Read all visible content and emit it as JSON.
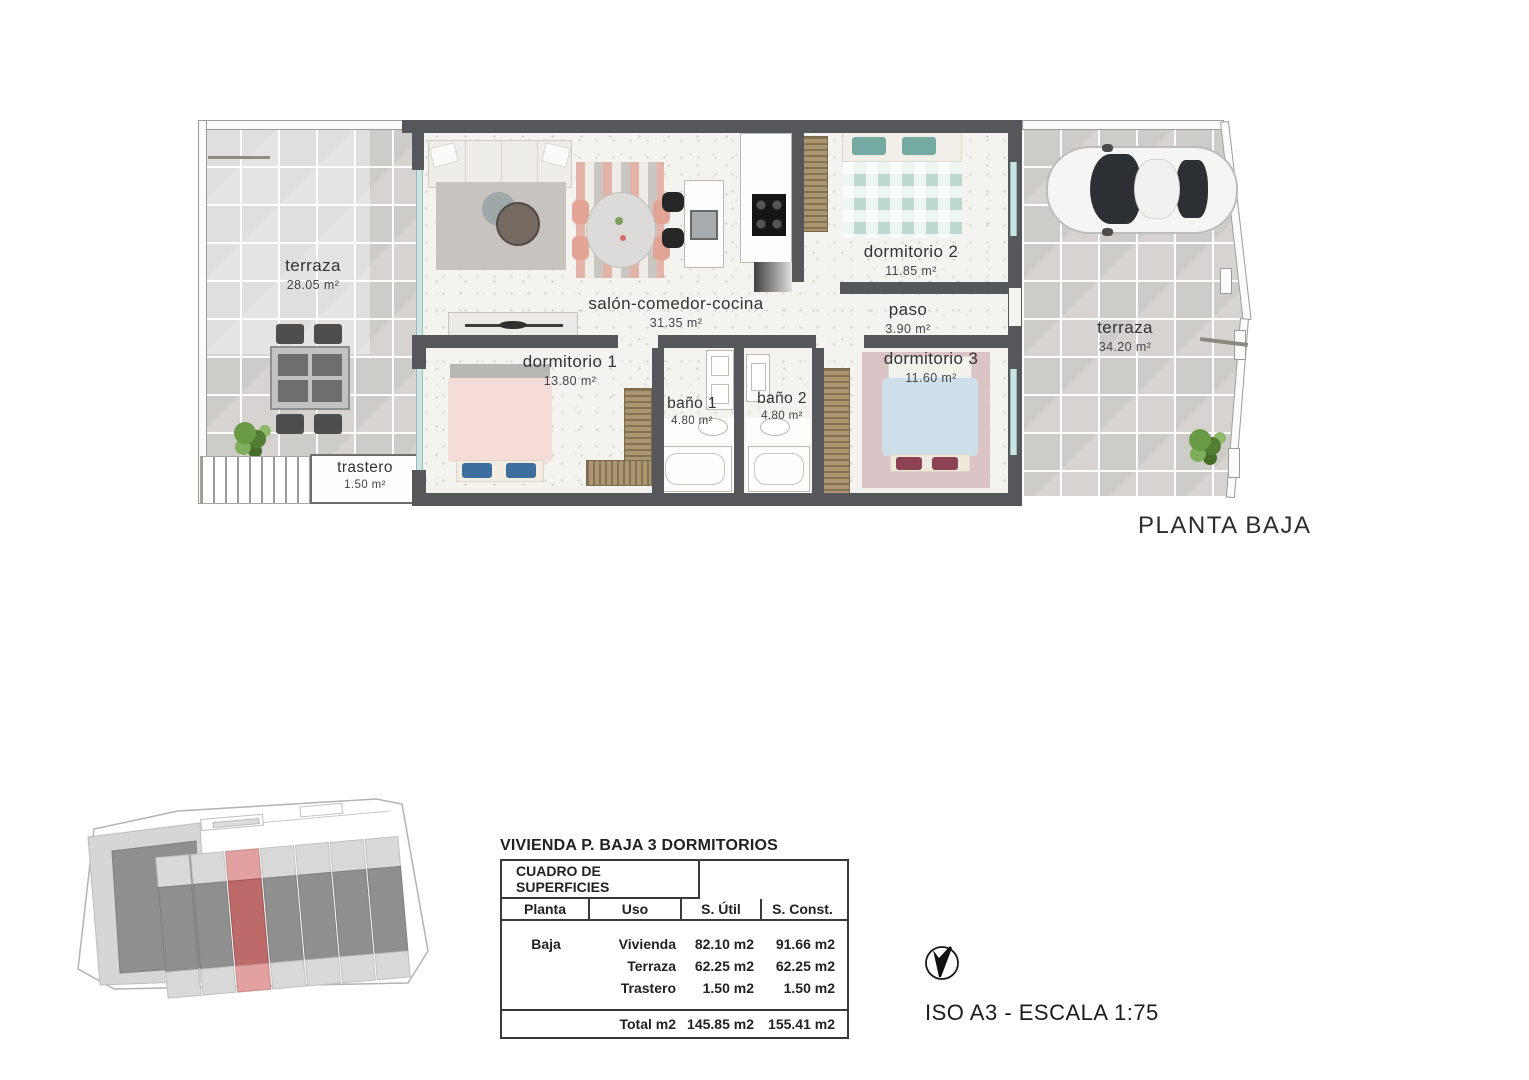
{
  "floorplan": {
    "title": "PLANTA BAJA",
    "rooms": {
      "terraza_izq": {
        "label": "terraza",
        "area": "28.05 m²"
      },
      "salon": {
        "label": "salón-comedor-cocina",
        "area": "31.35 m²"
      },
      "dormitorio2": {
        "label": "dormitorio 2",
        "area": "11.85 m²"
      },
      "paso": {
        "label": "paso",
        "area": "3.90 m²"
      },
      "dormitorio1": {
        "label": "dormitorio 1",
        "area": "13.80 m²"
      },
      "bano1": {
        "label": "baño 1",
        "area": "4.80 m²"
      },
      "bano2": {
        "label": "baño 2",
        "area": "4.80 m²"
      },
      "dormitorio3": {
        "label": "dormitorio 3",
        "area": "11.60 m²"
      },
      "terraza_der": {
        "label": "terraza",
        "area": "34.20 m²"
      },
      "trastero": {
        "label": "trastero",
        "area": "1.50 m²"
      }
    }
  },
  "summary": {
    "title": "VIVIENDA P. BAJA 3 DORMITORIOS",
    "table": {
      "header": "CUADRO DE SUPERFICIES",
      "columns": [
        "Planta",
        "Uso",
        "S. Útil",
        "S. Const."
      ],
      "rows": [
        {
          "planta": "Baja",
          "uso": "Vivienda",
          "util": "82.10 m2",
          "constr": "91.66 m2"
        },
        {
          "planta": "",
          "uso": "Terraza",
          "util": "62.25 m2",
          "constr": "62.25 m2"
        },
        {
          "planta": "",
          "uso": "Trastero",
          "util": "1.50 m2",
          "constr": "1.50 m2"
        }
      ],
      "total_label": "Total m2",
      "total_util": "145.85 m2",
      "total_constr": "155.41 m2"
    }
  },
  "compass": {
    "north_label": "N"
  },
  "footer": {
    "scale_note": "ISO A3 - ESCALA 1:75"
  },
  "colors": {
    "wall": "#56575b",
    "highlight_unit": "#bc6a6a",
    "window": "#c9e6e2"
  }
}
